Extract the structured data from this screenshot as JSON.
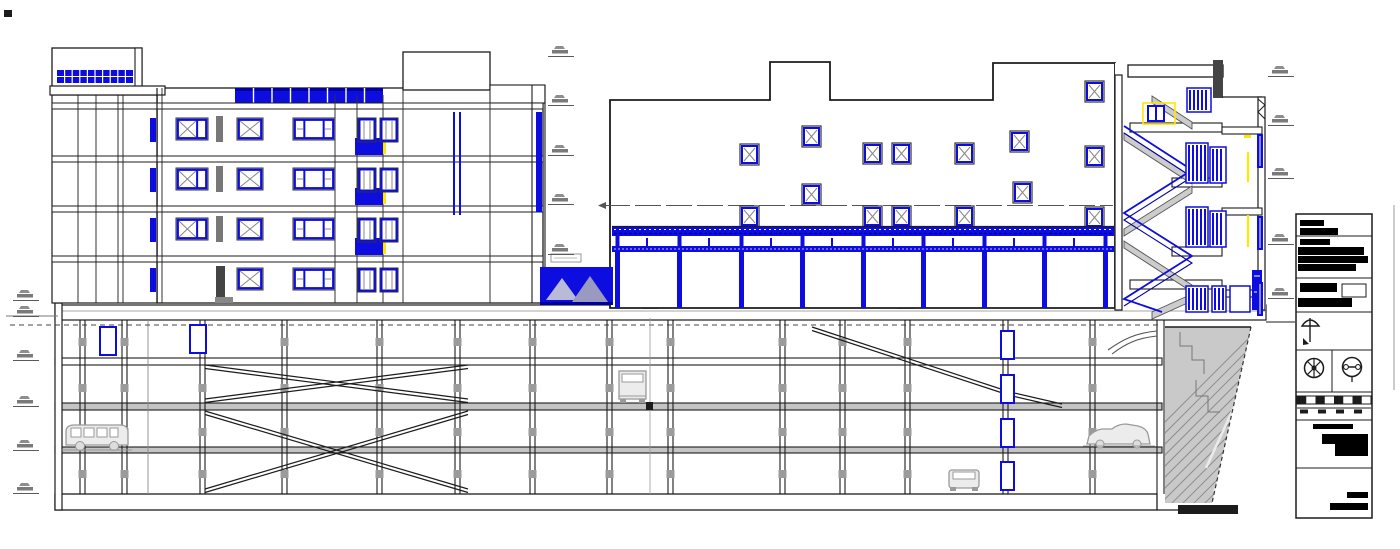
{
  "document": {
    "kind": "architectural-cad-section-drawing",
    "description": "Cross-section: five-storey residential block, mid building with roof pergola, sectioned stair tower, four-level underground parking garage with ramps and vehicles, earth hatch and title block",
    "sheet_tag": "SD-5"
  },
  "colors": {
    "background": "#ffffff",
    "ink": "#1c1c1c",
    "line_grey": "#8a8a8a",
    "detail_grey": "#c4c4c4",
    "blue": "#0d0de0",
    "blue_dark": "#0000a0",
    "yellow": "#ffe800",
    "earth_fill": "#c9c9c9",
    "earth_hatch": "#8f8f8f",
    "vehicle_grey": "#9a9a9a",
    "redaction_black": "#000000"
  },
  "structure": {
    "underground_parking_levels": 4,
    "left_building_window_rows": 4,
    "pergola_bays": 8,
    "stair_flights": 4,
    "vehicles": [
      "van-side",
      "truck-rear",
      "car-rear",
      "car-side"
    ],
    "elevation_markers_left": 6,
    "elevation_markers_middle": 5,
    "elevation_markers_right": 5
  },
  "title_block": {
    "sheet_tag": "SD-5",
    "rows": [
      "project-info-redacted",
      "drawing-info-redacted",
      "north-symbol",
      "stamp-logos",
      "scale-bar",
      "revision-redacted",
      "notes-redacted"
    ]
  }
}
